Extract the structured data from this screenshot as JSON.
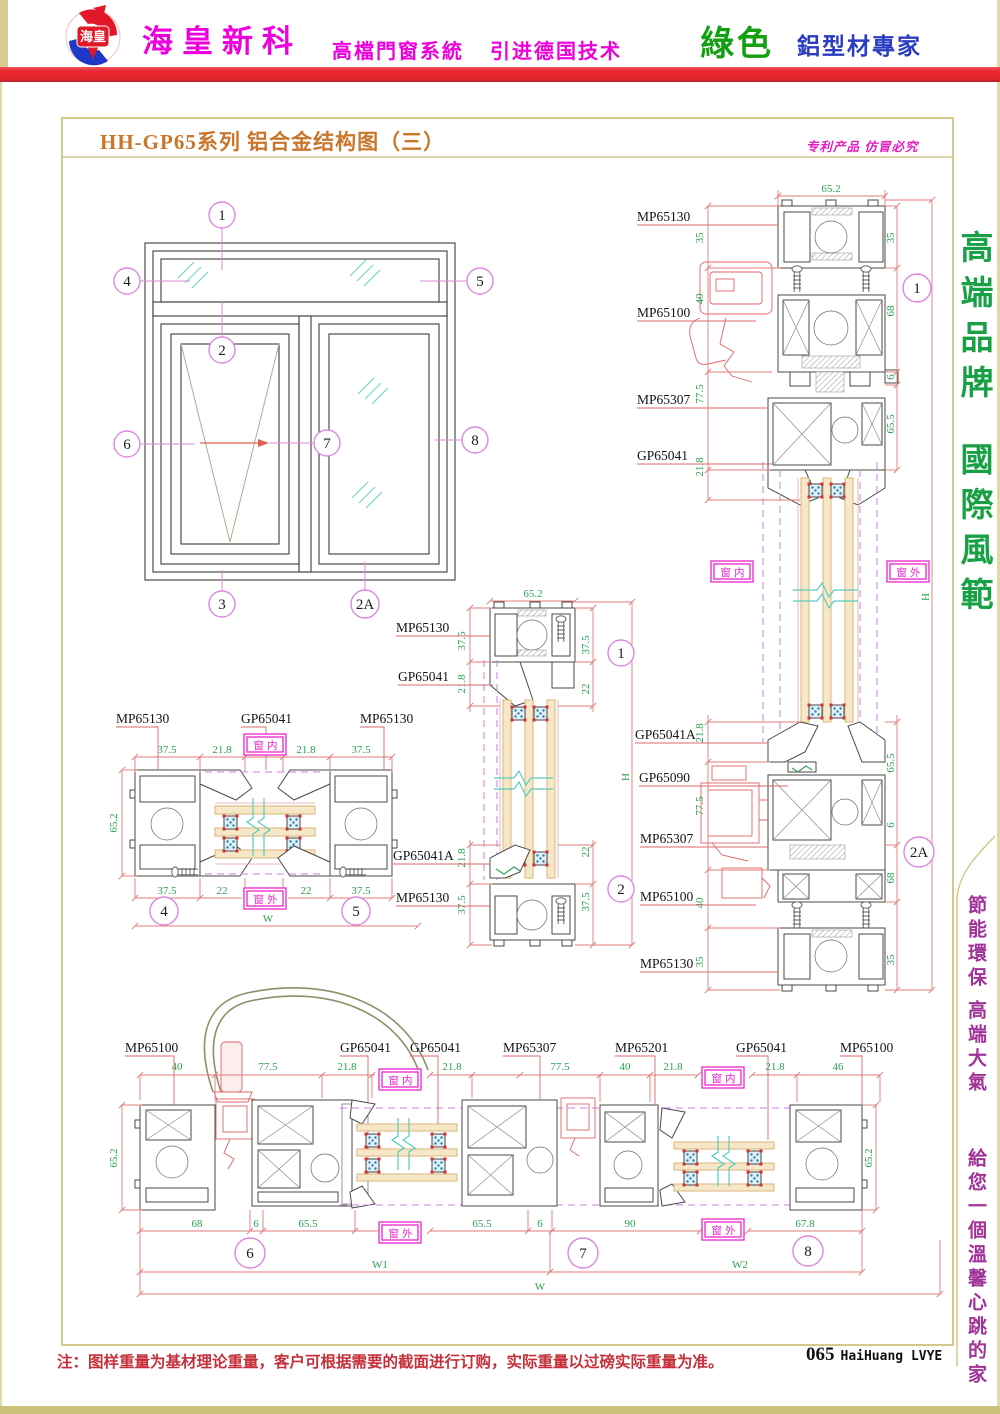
{
  "page": {
    "header": {
      "logo_text": "海皇",
      "company": "海皇新科",
      "tagline1": "高檔門窗系統",
      "tagline2": "引进德国技术",
      "brand_green": "綠色",
      "brand_blue": "鋁型材專家"
    },
    "title_bar": {
      "title": "HH-GP65系列  铝合金结构图（三）",
      "patent_note": "专利产品  仿冒必究"
    },
    "sidebar_right": {
      "slogan_top_1": "高端品牌",
      "slogan_top_2": "國際風範",
      "slogan_bottom_1": "節能環保",
      "slogan_bottom_2": "高端大氣",
      "slogan_bottom_3": "給您一個溫馨心跳的家"
    },
    "footer": {
      "note": "注：图样重量为基材理论重量，客户可根据需要的截面进行订购，实际重量以过磅实际重量为准。",
      "page_number": "065",
      "brand_mark": "HaiHuang LVYE"
    }
  },
  "colors": {
    "accent_red_bar": "#e8252f",
    "magenta": "#ee00dd",
    "green_brand": "#12a012",
    "blue_brand": "#2a3cc0",
    "title_orange": "#c9762b",
    "dim_text_green": "#2aa352",
    "dim_line_red": "#e07a7a",
    "anno_magenta": "#ee22cc",
    "callout_pink": "#dd88dd",
    "frame_tan": "#d4c98c"
  },
  "drawing": {
    "anno_inside": "窗内",
    "anno_outside": "窗外",
    "elevation": {
      "c1": "1",
      "c2": "2",
      "c3": "3",
      "c4": "4",
      "c5": "5",
      "c6": "6",
      "c7": "7",
      "c8": "8",
      "c2a": "2A"
    },
    "sec_right": {
      "dim_top": "65.2",
      "dim_h": "H",
      "callout_top": "1",
      "callout_bottom": "2A",
      "labels": [
        "MP65130",
        "MP65100",
        "MP65307",
        "GP65041",
        "GP65041A",
        "GP65090",
        "MP65307",
        "MP65100",
        "MP65130"
      ],
      "dims_left": [
        "35",
        "40",
        "77.5",
        "21.8",
        "21.8",
        "77.5",
        "40",
        "35"
      ],
      "dims_right": [
        "35",
        "68",
        "6",
        "65.5",
        "65.5",
        "6",
        "68",
        "35"
      ]
    },
    "sec_center": {
      "dim_top": "65.2",
      "dim_h": "H",
      "callout_top": "1",
      "callout_bottom": "2",
      "labels": [
        "MP65130",
        "GP65041",
        "GP65041A",
        "MP65130"
      ],
      "dims_left": [
        "37.5",
        "21.8",
        "21.8",
        "37.5"
      ],
      "dims_right": [
        "37.5",
        "22",
        "22",
        "37.5"
      ]
    },
    "sec_45": {
      "callout_left": "4",
      "callout_right": "5",
      "dim_side": "65.2",
      "dim_w": "W",
      "labels": [
        "MP65130",
        "GP65041",
        "MP65130"
      ],
      "dims_top": [
        "37.5",
        "21.8",
        "21.8",
        "37.5"
      ],
      "dims_bottom": [
        "37.5",
        "22",
        "22",
        "37.5"
      ]
    },
    "sec_bottom": {
      "callouts": [
        "6",
        "7",
        "8"
      ],
      "dim_left": "65.2",
      "dim_right": "65.2",
      "dim_w1": "W1",
      "dim_w2": "W2",
      "dim_w": "W",
      "labels": [
        "MP65100",
        "GP65041",
        "GP65041",
        "MP65307",
        "MP65201",
        "GP65041",
        "MP65100"
      ],
      "dims_top": [
        "40",
        "77.5",
        "21.8",
        "21.8",
        "77.5",
        "40",
        "21.8",
        "21.8",
        "46"
      ],
      "dims_bottom": [
        "68",
        "6",
        "65.5",
        "65.5",
        "6",
        "90",
        "67.8"
      ]
    }
  }
}
